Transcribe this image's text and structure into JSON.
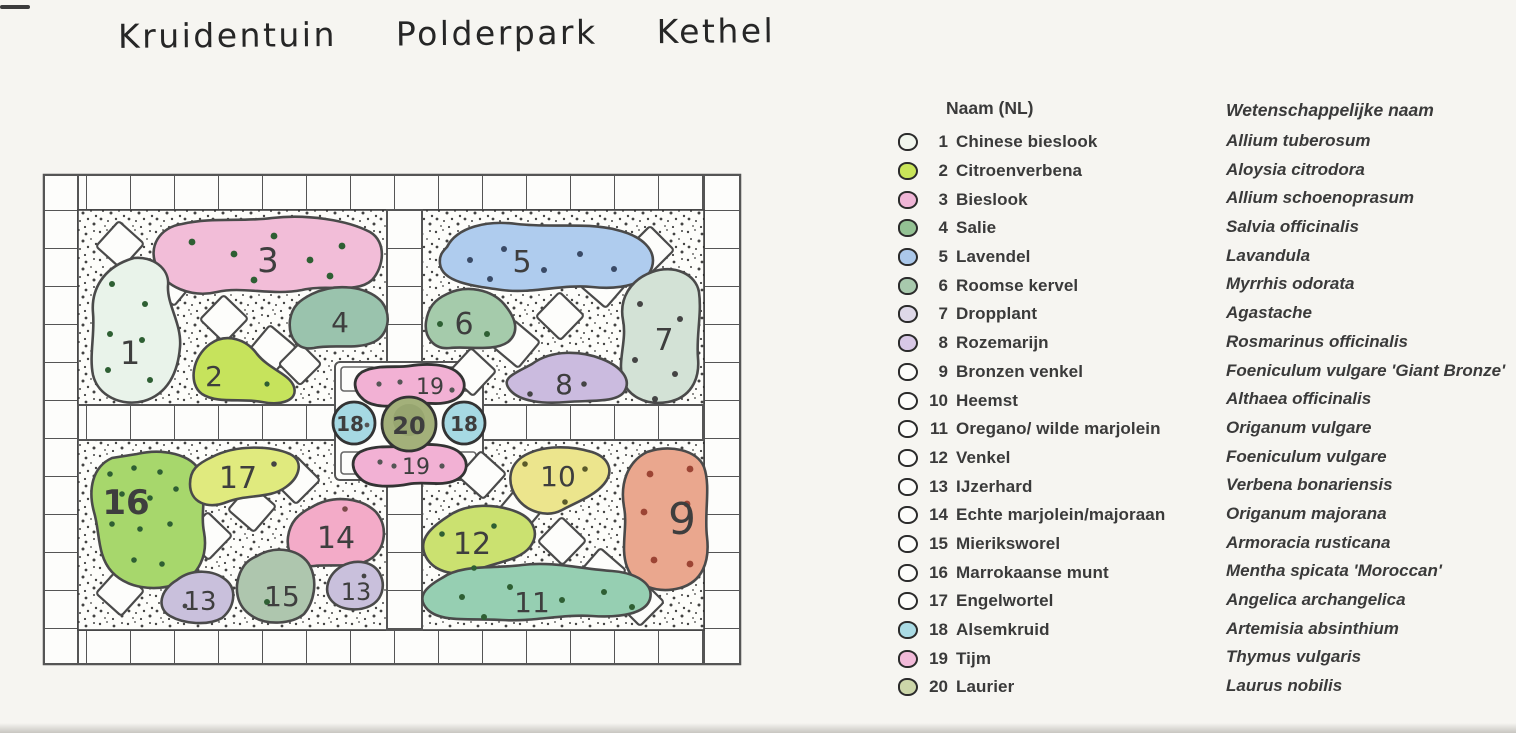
{
  "title": "Kruidentuin Polderpark Kethel",
  "legend": {
    "name_header": "Naam (NL)",
    "sci_header": "Wetenschappelijke naam",
    "items": [
      {
        "num": "1",
        "nl": "Chinese bieslook",
        "sci": "Allium tuberosum",
        "swatch": "#f1f6ed"
      },
      {
        "num": "2",
        "nl": "Citroenverbena",
        "sci": "Aloysia citrodora",
        "swatch": "#c9e559"
      },
      {
        "num": "3",
        "nl": "Bieslook",
        "sci": "Allium schoenoprasum",
        "swatch": "#efb5d6"
      },
      {
        "num": "4",
        "nl": "Salie",
        "sci": "Salvia officinalis",
        "swatch": "#93c193"
      },
      {
        "num": "5",
        "nl": "Lavendel",
        "sci": "Lavandula",
        "swatch": "#abc8ea"
      },
      {
        "num": "6",
        "nl": "Roomse kervel",
        "sci": "Myrrhis odorata",
        "swatch": "#a8c9ad"
      },
      {
        "num": "7",
        "nl": "Dropplant",
        "sci": "Agastache",
        "swatch": "#ded8e8"
      },
      {
        "num": "8",
        "nl": "Rozemarijn",
        "sci": "Rosmarinus officinalis",
        "swatch": "#d8c8e6"
      },
      {
        "num": "9",
        "nl": "Bronzen venkel",
        "sci": "Foeniculum vulgare 'Giant Bronze'",
        "swatch": "#fdfdfb"
      },
      {
        "num": "10",
        "nl": "Heemst",
        "sci": "Althaea officinalis",
        "swatch": "#fdfdfb"
      },
      {
        "num": "11",
        "nl": "Oregano/ wilde marjolein",
        "sci": "Origanum vulgare",
        "swatch": "#fdfdfb"
      },
      {
        "num": "12",
        "nl": "Venkel",
        "sci": "Foeniculum vulgare",
        "swatch": "#fdfdfb"
      },
      {
        "num": "13",
        "nl": "IJzerhard",
        "sci": "Verbena bonariensis",
        "swatch": "#fdfdfb"
      },
      {
        "num": "14",
        "nl": "Echte marjolein/majoraan",
        "sci": "Origanum majorana",
        "swatch": "#fdfdfb"
      },
      {
        "num": "15",
        "nl": "Mieriksworel",
        "sci": "Armoracia rusticana",
        "swatch": "#fdfdfb"
      },
      {
        "num": "16",
        "nl": "Marrokaanse munt",
        "sci": "Mentha spicata 'Moroccan'",
        "swatch": "#fdfdfb"
      },
      {
        "num": "17",
        "nl": "Engelwortel",
        "sci": "Angelica archangelica",
        "swatch": "#fdfdfb"
      },
      {
        "num": "18",
        "nl": "Alsemkruid",
        "sci": "Artemisia absinthium",
        "swatch": "#aadbe4"
      },
      {
        "num": "19",
        "nl": "Tijm",
        "sci": "Thymus vulgaris",
        "swatch": "#f2bad9"
      },
      {
        "num": "20",
        "nl": "Laurier",
        "sci": "Laurus nobilis",
        "swatch": "#ccd6a9"
      }
    ]
  },
  "plan_labels": {
    "b1": "1",
    "b2": "2",
    "b3": "3",
    "b4": "4",
    "b5": "5",
    "b6": "6",
    "b7": "7",
    "b8": "8",
    "b9": "9",
    "b10": "10",
    "b11": "11",
    "b12": "12",
    "b13": "13",
    "b14": "14",
    "b15": "15",
    "b16": "16",
    "b17": "17",
    "b18": "18",
    "b19": "19",
    "b20": "20"
  },
  "plan_colors": {
    "b1": "#e9f3ea",
    "b2": "#c6e35c",
    "b3": "#f2bdd8",
    "b4": "#9ac3ad",
    "b5": "#afccee",
    "b6": "#a5cbab",
    "b7": "#d3e2d6",
    "b8": "#cbbbdf",
    "b9": "#eaa78e",
    "b10": "#ece58d",
    "b11": "#96cfb2",
    "b12": "#cbe170",
    "b13": "#c9c0dc",
    "b14": "#f3abc8",
    "b15": "#aec6ae",
    "b16": "#a7d76c",
    "b17": "#e0ea7e",
    "b18": "#a6d9e3",
    "b19": "#f2b1d4",
    "b20": "#a3b07a",
    "ink": "#4a4a4a",
    "dot_green": "#2e5f33",
    "dot_red": "#9c4434"
  }
}
